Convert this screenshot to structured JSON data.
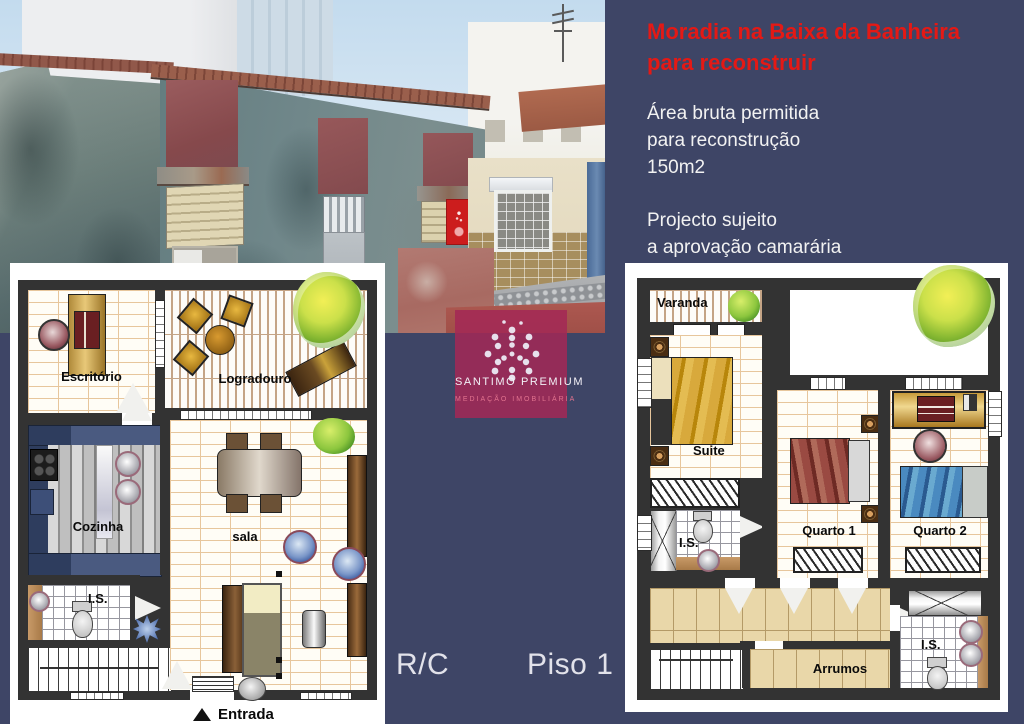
{
  "colors": {
    "background": "#3e4566",
    "title_red": "#e41915",
    "plan_wall": "#333333",
    "logo_bg": "rgba(163,40,86,0.85)",
    "sign_red": "#cc1d1d"
  },
  "header": {
    "title_lines": [
      "Moradia na Baixa da Banheira",
      "para reconstruir"
    ],
    "info_lines": [
      "Área bruta permitida",
      "para reconstrução",
      "150m2"
    ],
    "note_lines": [
      "Projecto sujeito",
      "a aprovação camarária"
    ]
  },
  "logo": {
    "name": "SANTIMO PREMIUM",
    "tagline": "MEDIAÇÃO IMOBILIÁRIA"
  },
  "plans": {
    "rc": {
      "caption": "R/C",
      "labels": {
        "office": "Escritório",
        "patio": "Logradouro",
        "kitchen": "Cozinha",
        "living": "sala",
        "wc": "I.S.",
        "entrance": "Entrada"
      }
    },
    "piso1": {
      "caption": "Piso 1",
      "labels": {
        "balcony": "Varanda",
        "suite": "Suite",
        "bedroom1": "Quarto 1",
        "bedroom2": "Quarto 2",
        "wc_top": "I.S.",
        "wc_bottom": "I.S.",
        "storage": "Arrumos"
      }
    }
  }
}
